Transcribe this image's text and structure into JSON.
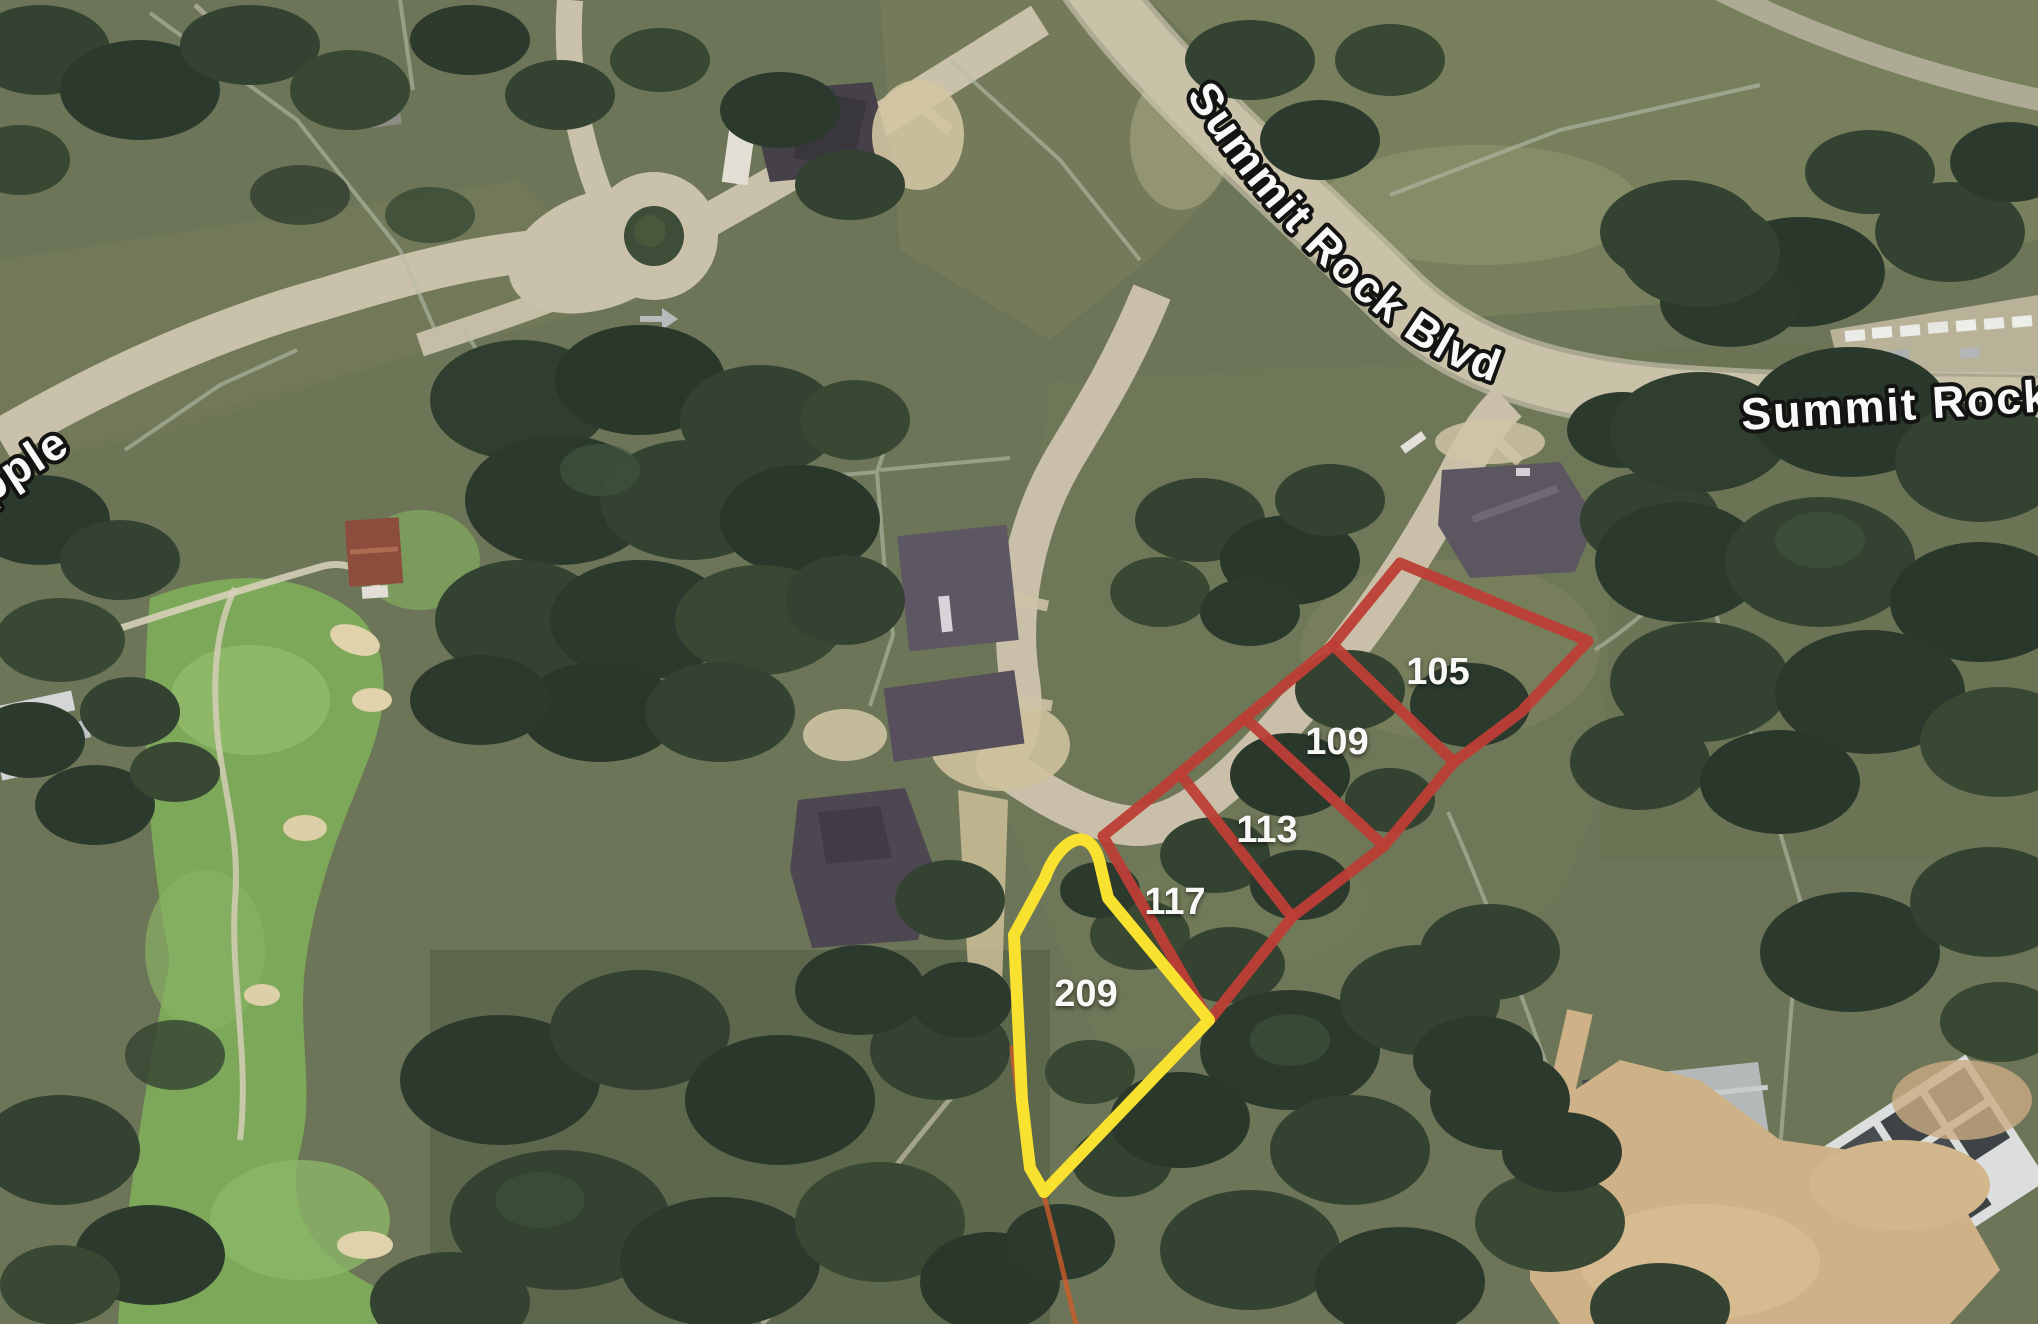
{
  "page": {
    "title": "Satellite lot map"
  },
  "map": {
    "street_labels": [
      {
        "name": "summit-rock-blvd-curved",
        "text": "Summit Rock Blvd"
      },
      {
        "name": "summit-rock-right",
        "text": "Summit Rock"
      },
      {
        "name": "left-street-partial",
        "text": "pple"
      }
    ],
    "lots": [
      {
        "number": "105",
        "outline": "red"
      },
      {
        "number": "109",
        "outline": "red"
      },
      {
        "number": "113",
        "outline": "red"
      },
      {
        "number": "117",
        "outline": "red"
      },
      {
        "number": "209",
        "outline": "yellow"
      }
    ],
    "colors": {
      "red_outline": "#c13a31",
      "yellow_outline": "#ffe72b",
      "orange_lot_line": "#cf5a26",
      "label_text": "#ffffff",
      "road_label_fill": "#ffffff",
      "road_label_stroke": "#0c0c0c"
    }
  }
}
